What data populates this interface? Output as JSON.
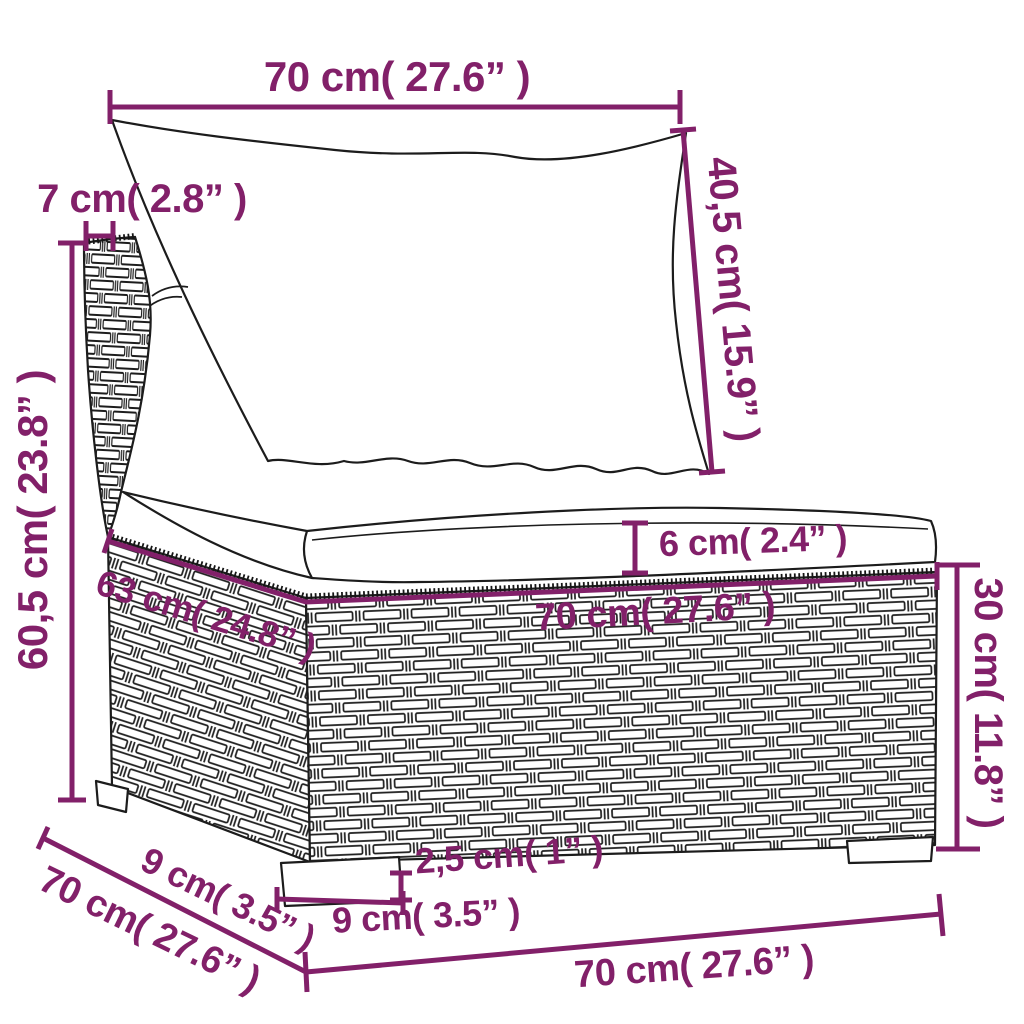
{
  "figure": {
    "kind": "product-dimension-diagram",
    "subject": "poly-rattan garden sofa middle section with back pillow and seat cushion",
    "background_color": "#ffffff",
    "line_color": "#1c1c1c",
    "accent_color": "#822069"
  },
  "dims": {
    "top_width": {
      "label": "70 cm( 27.6” )",
      "cm": 70,
      "inch": 27.6
    },
    "back_panel_width": {
      "label": "7 cm( 2.8” )",
      "cm": 7,
      "inch": 2.8
    },
    "total_height": {
      "label": "60,5 cm( 23.8” )",
      "cm": 60.5,
      "inch": 23.8
    },
    "backrest_height": {
      "label": "40,5 cm( 15.9” )",
      "cm": 40.5,
      "inch": 15.9
    },
    "cushion_thickness": {
      "label": "6 cm( 2.4” )",
      "cm": 6,
      "inch": 2.4
    },
    "seat_width": {
      "label": "70 cm( 27.6” )",
      "cm": 70,
      "inch": 27.6
    },
    "seat_depth_inner": {
      "label": "63 cm( 24.8” )",
      "cm": 63,
      "inch": 24.8
    },
    "base_height": {
      "label": "30 cm( 11.8” )",
      "cm": 30,
      "inch": 11.8
    },
    "side_edge_small": {
      "label": "9 cm( 3.5” )",
      "cm": 9,
      "inch": 3.5
    },
    "base_depth": {
      "label": "70 cm( 27.6” )",
      "cm": 70,
      "inch": 27.6
    },
    "front_foot_width": {
      "label": "9 cm( 3.5” )",
      "cm": 9,
      "inch": 3.5
    },
    "foot_height": {
      "label": "2,5 cm( 1” )",
      "cm": 2.5,
      "inch": 1
    },
    "base_width": {
      "label": "70 cm( 27.6” )",
      "cm": 70,
      "inch": 27.6
    }
  }
}
